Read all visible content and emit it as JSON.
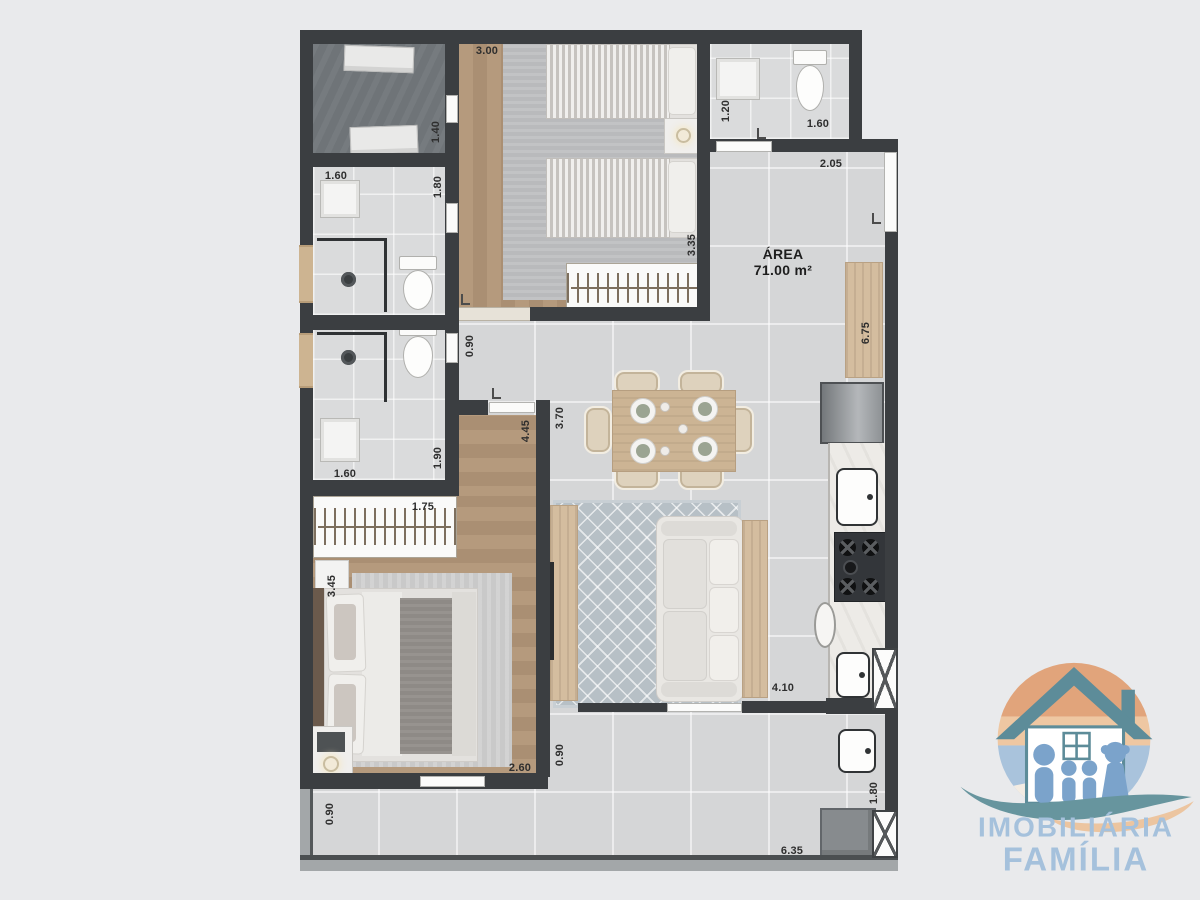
{
  "floorplan": {
    "area_label": {
      "title": "ÁREA",
      "value": "71.00 m²"
    },
    "dimensions": [
      {
        "text": "3.00",
        "x": 487,
        "y": 51,
        "v": 0
      },
      {
        "text": "1.40",
        "x": 436,
        "y": 132,
        "v": 1
      },
      {
        "text": "1.60",
        "x": 336,
        "y": 176,
        "v": 0
      },
      {
        "text": "1.80",
        "x": 438,
        "y": 187,
        "v": 1
      },
      {
        "text": "1.20",
        "x": 726,
        "y": 111,
        "v": 1
      },
      {
        "text": "1.60",
        "x": 818,
        "y": 124,
        "v": 0
      },
      {
        "text": "2.05",
        "x": 831,
        "y": 164,
        "v": 0
      },
      {
        "text": "3.35",
        "x": 692,
        "y": 245,
        "v": 1
      },
      {
        "text": "6.75",
        "x": 866,
        "y": 333,
        "v": 1
      },
      {
        "text": "0.90",
        "x": 470,
        "y": 346,
        "v": 1
      },
      {
        "text": "3.70",
        "x": 560,
        "y": 418,
        "v": 1
      },
      {
        "text": "4.45",
        "x": 526,
        "y": 431,
        "v": 1
      },
      {
        "text": "1.90",
        "x": 438,
        "y": 458,
        "v": 1
      },
      {
        "text": "1.60",
        "x": 345,
        "y": 474,
        "v": 0
      },
      {
        "text": "1.75",
        "x": 423,
        "y": 507,
        "v": 0
      },
      {
        "text": "3.45",
        "x": 332,
        "y": 586,
        "v": 1
      },
      {
        "text": "2.60",
        "x": 520,
        "y": 768,
        "v": 0
      },
      {
        "text": "0.90",
        "x": 560,
        "y": 755,
        "v": 1
      },
      {
        "text": "4.10",
        "x": 783,
        "y": 688,
        "v": 0
      },
      {
        "text": "1.80",
        "x": 874,
        "y": 793,
        "v": 1
      },
      {
        "text": "0.90",
        "x": 330,
        "y": 814,
        "v": 1
      },
      {
        "text": "6.35",
        "x": 792,
        "y": 851,
        "v": 0
      }
    ],
    "colors": {
      "wall": "#3b3e41",
      "floor_tile": "#d5d6d7",
      "wood_floor": "#ab9176",
      "service_floor": "#6f7478"
    }
  },
  "logo": {
    "line1": "IMOBILIÁRIA",
    "line2": "FAMÍLIA",
    "colors": {
      "text_blue": "#a5c1dc",
      "teal": "#5d8c99",
      "figure_blue": "#7ba3cb",
      "orange": "#e1a47b",
      "peach": "#eec7a2",
      "sky": "#a9c3dc"
    }
  }
}
